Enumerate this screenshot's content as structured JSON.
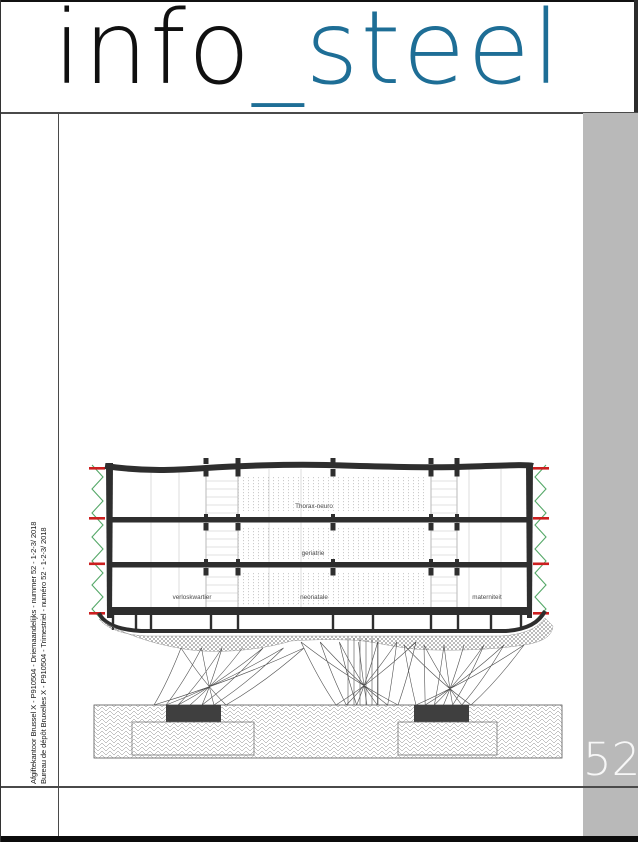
{
  "logo": {
    "black_part": "info",
    "teal_part": "_steel"
  },
  "issue": {
    "number": "52"
  },
  "imprint": {
    "line1": "Afgiftekantoor Brussel X - P910504 - Driemaandelijks - nummer 52 - 1-2-3/ 2018",
    "line2": "Bureau de dépôt Bruxelles X - P910504 - Trimestriel - numéro 52 - 1-2-3/ 2018"
  },
  "drawing": {
    "floor_labels": {
      "top": "Thorax-neuro",
      "middle": "geriatrie",
      "bottom_left": "verloskwartier",
      "bottom_center": "neonatale",
      "bottom_right": "materniteit"
    }
  },
  "colors": {
    "teal": "#1e6e96",
    "panel_gray": "#b9b9b9",
    "ink": "#2e2e2e",
    "red": "#cb1f1f",
    "green": "#55a868"
  }
}
